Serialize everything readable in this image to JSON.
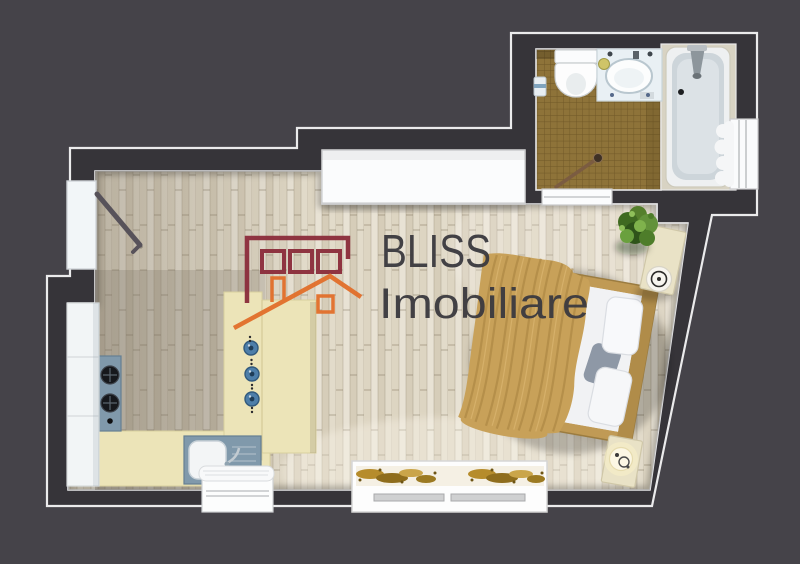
{
  "watermark": {
    "brand": "BLISS",
    "subtitle": "Imobiliare"
  },
  "palette": {
    "background": "#454349",
    "wall": "#363439",
    "outline": "#ebebec",
    "wood_floor_base": "#e0d8c7",
    "bathroom_tile": "#8e7339",
    "bathtub_inner": "#cdd5da",
    "kitchen_counter": "#ece4b8",
    "kitchen_appliance": "#8099ab",
    "white_furniture": "#fbfcfd",
    "bed_frame": "#c09a55",
    "bed_blanket": "#c8a159",
    "bedding_white": "#ecedef",
    "nightstand": "#e9e2c6",
    "plant_green": "#4a7a2b",
    "gold_ornament": "#b68c2c",
    "logo_maroon": "#8c2e3c",
    "logo_orange": "#e2702c",
    "logo_text": "#3c3b40"
  },
  "plan": {
    "type": "studio-apartment-floor-plan-top-view",
    "rooms": [
      {
        "name": "main-room",
        "floor": "light-wood-planks"
      },
      {
        "name": "bathroom",
        "floor": "brown-mosaic-tile"
      }
    ],
    "objects": [
      "entry-door",
      "built-in-wardrobe",
      "double-bed",
      "gold-throw-blanket",
      "pillows",
      "nightstand-top",
      "nightstand-lamp-top",
      "nightstand-bottom",
      "nightstand-lamp-bottom",
      "decorative-plant",
      "foot-bench-gold-decor",
      "window-bottom-center",
      "towel-cabinet",
      "kitchen-tall-cabinet",
      "gas-hob",
      "kitchen-counter",
      "bar-counter",
      "blue-knobs",
      "kitchen-sink",
      "toilet",
      "waste-bin",
      "vanity-sink",
      "bathtub-shower",
      "shower-head",
      "towel-rail",
      "bathroom-window-bottom",
      "bathroom-window-right"
    ]
  }
}
